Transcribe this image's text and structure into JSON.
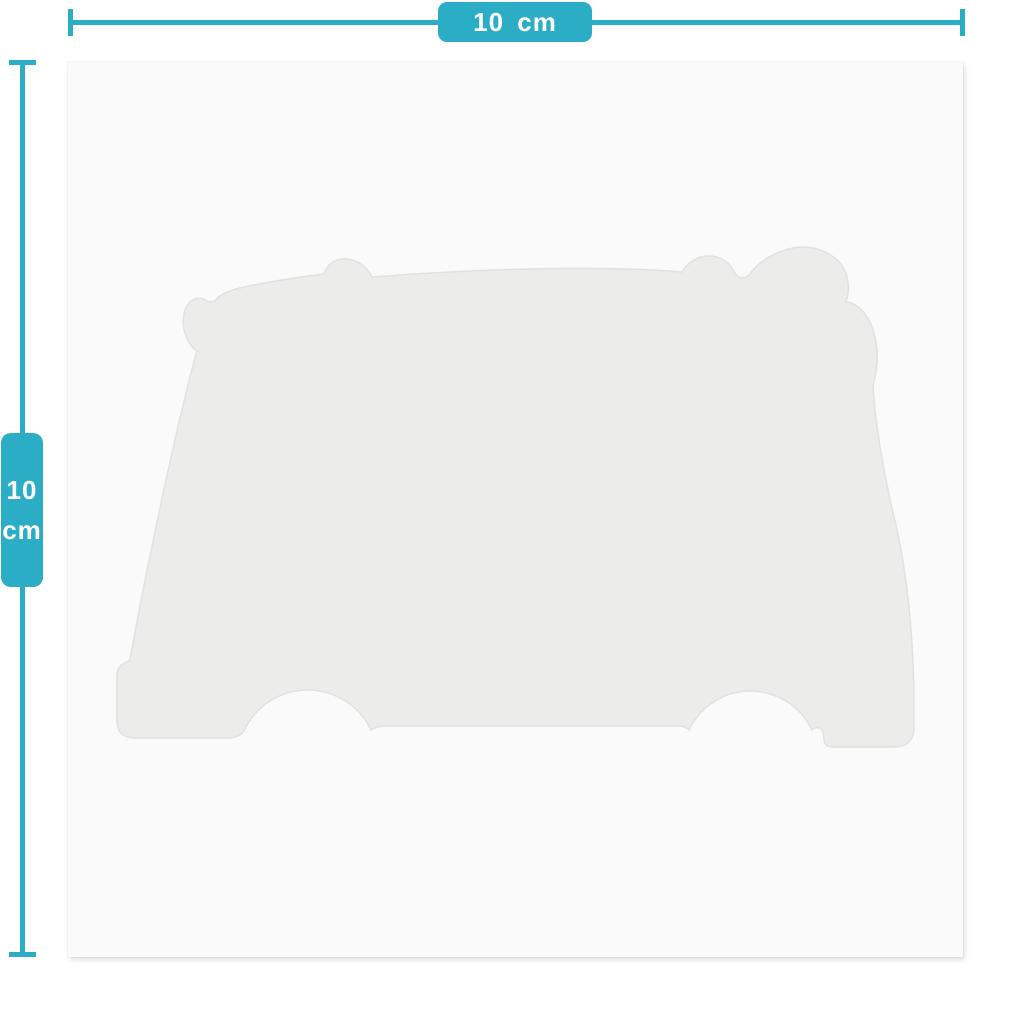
{
  "page": {
    "description": "Product size diagram: 10 cm x 10 cm die-cut sticker sheet with faint camper-van silhouette",
    "background_color": "#FFFFFF"
  },
  "dimensions": {
    "width": {
      "text": "10 cm"
    },
    "height": {
      "line1": "10",
      "line2": "cm"
    }
  },
  "product": {
    "shape_name": "camper-van-silhouette",
    "canvas_color": "#FAFAFA",
    "silhouette_color": "#ECECEB"
  },
  "colors": {
    "accent_teal": "#2BADC6",
    "label_text": "#FFFFFF"
  }
}
